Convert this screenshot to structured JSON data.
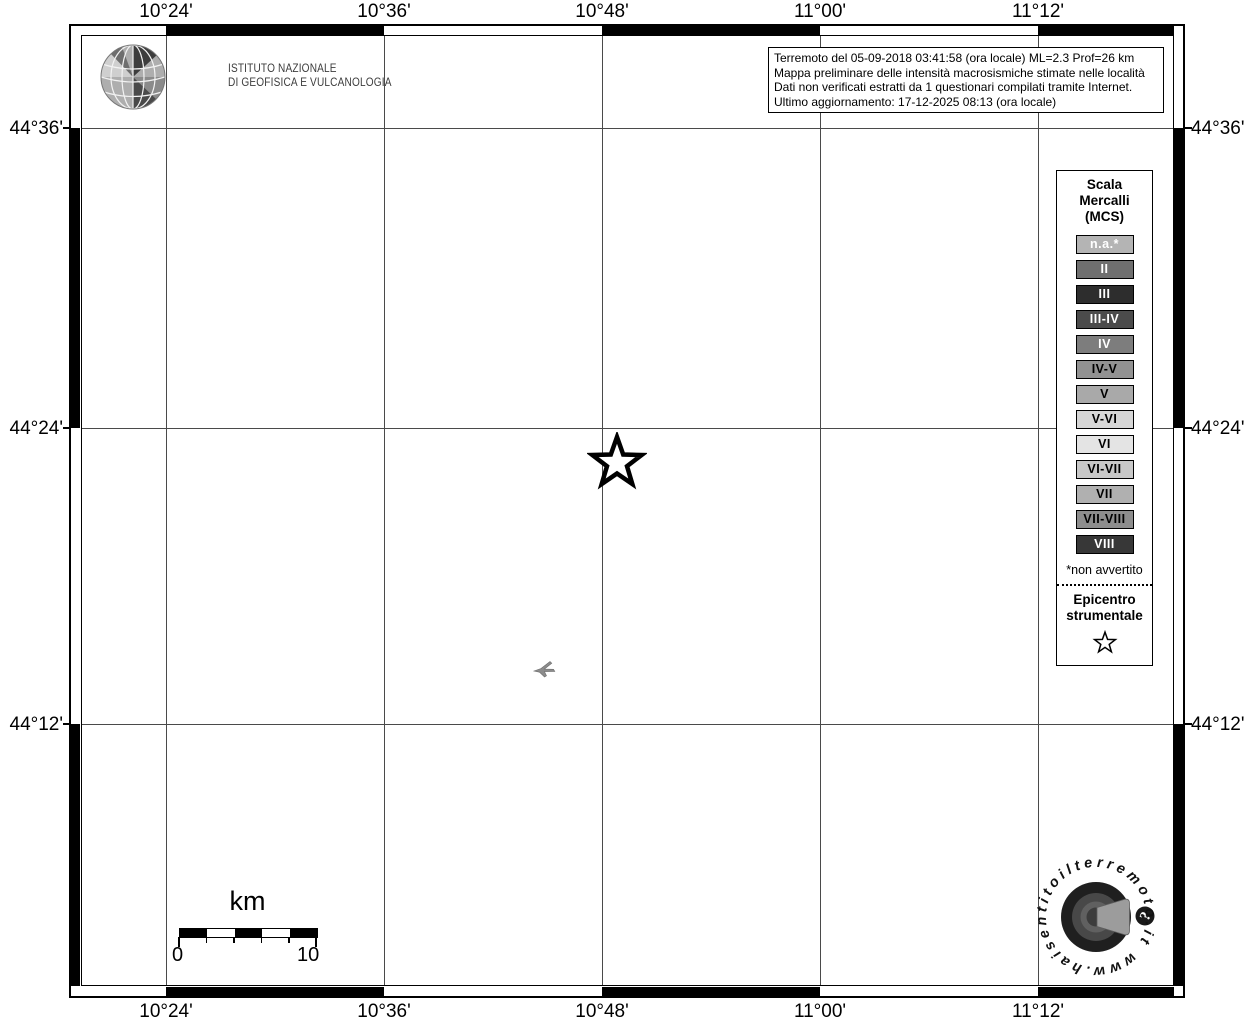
{
  "branding": {
    "institute_line1": "ISTITUTO NAZIONALE",
    "institute_line2": "DI GEOFISICA E VULCANOLOGIA"
  },
  "info_box": {
    "lines": [
      "Terremoto del 05-09-2018 03:41:58 (ora locale) ML=2.3 Prof=26 km",
      "Mappa preliminare delle intensità macrosismiche stimate nelle località",
      "Dati non verificati estratti da 1 questionari compilati tramite Internet.",
      "Ultimo aggiornamento: 17-12-2025 08:13 (ora locale)"
    ]
  },
  "axes": {
    "top_labels": [
      "10°24'",
      "10°36'",
      "10°48'",
      "11°00'",
      "11°12'"
    ],
    "bottom_labels": [
      "10°24'",
      "10°36'",
      "10°48'",
      "11°00'",
      "11°12'"
    ],
    "left_labels": [
      "44°36'",
      "44°24'",
      "44°12'"
    ],
    "right_labels": [
      "44°36'",
      "44°24'",
      "44°12'"
    ]
  },
  "legend": {
    "title_line1": "Scala",
    "title_line2": "Mercalli",
    "title_line3": "(MCS)",
    "items": [
      {
        "label": "n.a.*",
        "bg": "#b4b4b4",
        "fg": "#ffffff"
      },
      {
        "label": "II",
        "bg": "#6f6f6f",
        "fg": "#ffffff"
      },
      {
        "label": "III",
        "bg": "#2d2d2d",
        "fg": "#ffffff"
      },
      {
        "label": "III-IV",
        "bg": "#4b4b4b",
        "fg": "#ffffff"
      },
      {
        "label": "IV",
        "bg": "#7d7d7d",
        "fg": "#ffffff"
      },
      {
        "label": "IV-V",
        "bg": "#929292",
        "fg": "#000000"
      },
      {
        "label": "V",
        "bg": "#a9a9a9",
        "fg": "#000000"
      },
      {
        "label": "V-VI",
        "bg": "#d6d6d6",
        "fg": "#000000"
      },
      {
        "label": "VI",
        "bg": "#e4e4e4",
        "fg": "#000000"
      },
      {
        "label": "VI-VII",
        "bg": "#c8c8c8",
        "fg": "#000000"
      },
      {
        "label": "VII",
        "bg": "#b0b0b0",
        "fg": "#000000"
      },
      {
        "label": "VII-VIII",
        "bg": "#8d8d8d",
        "fg": "#000000"
      },
      {
        "label": "VIII",
        "bg": "#373737",
        "fg": "#ffffff"
      }
    ],
    "footnote": "*non avvertito",
    "epicenter_line1": "Epicentro",
    "epicenter_line2": "strumentale"
  },
  "scale_bar": {
    "unit_label": "km",
    "min_label": "0",
    "max_label": "10"
  },
  "watermark": {
    "circular_text": "www.haisentitoilterremoto.it",
    "badge_glyph": "?"
  }
}
